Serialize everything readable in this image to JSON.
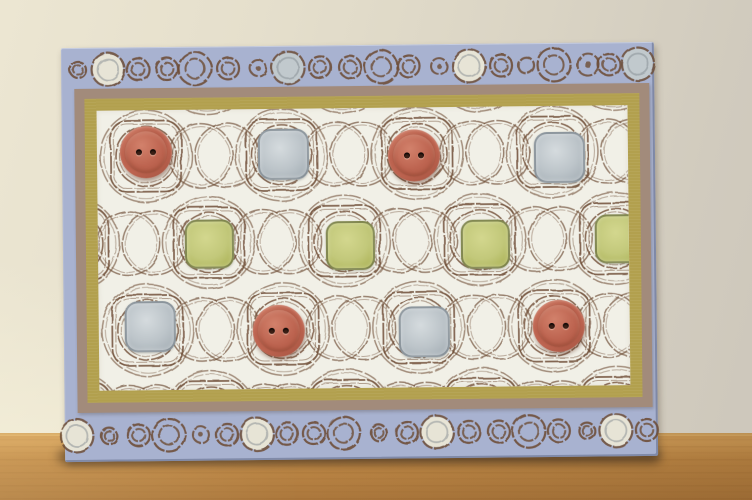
{
  "scene": {
    "type": "photograph",
    "description": "Handmade greeting card leaning against a textured beige plaster wall, standing on a light oak table. Periwinkle-blue card with hand-stamped circle borders top and bottom; central white panel matted in tan and olive-gold, stamped with an interlocking brown pattern of rounded squares and circles. Cells are embellished with terracotta two-hole buttons, celery-green squares and silver-grey squares.",
    "wall": {
      "color_left": "#ece6d2",
      "color_mid": "#dad4c4",
      "color_right": "#cdc7bb"
    },
    "table": {
      "top_y": 433,
      "edge": "#dcae68",
      "light": "#d09c57",
      "main": "#bf8947",
      "dark": "#ab773c"
    },
    "card_contact_shadow": {
      "x": 58,
      "y": 450,
      "width": 602,
      "height": 13
    }
  },
  "card": {
    "x": 63,
    "y": 45,
    "width": 593,
    "height": 414,
    "rotation_deg": -0.6,
    "base_color": "#a8b2d0",
    "ink": "#6f4e36",
    "border_ink": "#6d4c36",
    "cream_fill": "#e7e4d6",
    "silver_fill": "#c1c9cd",
    "inner_ring_gray": "rgba(130,138,144,0.55)",
    "outer_mat": {
      "color": "#a28b7b",
      "x": 13,
      "y": 41,
      "width": 575,
      "height": 324
    },
    "inner_mat": {
      "color": "#b2a04e",
      "inset": 10
    },
    "paper": {
      "color": "#f1f0e7",
      "inset": 12,
      "width": 531,
      "height": 280
    },
    "border_sizes": {
      "L": 16.5,
      "m": 11,
      "s": 8
    },
    "top_border": {
      "cy": 22,
      "circles": [
        {
          "x": 17,
          "size": "s",
          "style": "ring2"
        },
        {
          "x": 47,
          "size": "L",
          "style": "cream"
        },
        {
          "x": 77,
          "size": "m",
          "style": "ring2"
        },
        {
          "x": 106,
          "size": "m",
          "style": "ring2"
        },
        {
          "x": 134,
          "size": "L",
          "style": "ring2"
        },
        {
          "x": 167,
          "size": "m",
          "style": "ring2"
        },
        {
          "x": 197,
          "size": "s",
          "style": "dot"
        },
        {
          "x": 227,
          "size": "L",
          "style": "silver"
        },
        {
          "x": 259,
          "size": "m",
          "style": "ring2"
        },
        {
          "x": 289,
          "size": "m",
          "style": "ring2"
        },
        {
          "x": 320,
          "size": "L",
          "style": "ring2"
        },
        {
          "x": 348,
          "size": "m",
          "style": "ring2"
        },
        {
          "x": 378,
          "size": "s",
          "style": "dot"
        },
        {
          "x": 408,
          "size": "L",
          "style": "cream"
        },
        {
          "x": 440,
          "size": "m",
          "style": "ring2"
        },
        {
          "x": 465,
          "size": "s",
          "style": "ring"
        },
        {
          "x": 493,
          "size": "L",
          "style": "ring2"
        },
        {
          "x": 527,
          "size": "m",
          "style": "dot"
        },
        {
          "x": 548,
          "size": "m",
          "style": "ring2"
        },
        {
          "x": 577,
          "size": "L",
          "style": "silver"
        }
      ]
    },
    "bottom_border": {
      "cy": 22,
      "circles": [
        {
          "x": 12,
          "size": "L",
          "style": "cream"
        },
        {
          "x": 44,
          "size": "s",
          "style": "ring2"
        },
        {
          "x": 74,
          "size": "m",
          "style": "ring2"
        },
        {
          "x": 104,
          "size": "L",
          "style": "ring2"
        },
        {
          "x": 136,
          "size": "s",
          "style": "dot"
        },
        {
          "x": 162,
          "size": "m",
          "style": "ring2"
        },
        {
          "x": 192,
          "size": "L",
          "style": "cream"
        },
        {
          "x": 222,
          "size": "m",
          "style": "ring2"
        },
        {
          "x": 249,
          "size": "m",
          "style": "ring2"
        },
        {
          "x": 279,
          "size": "L",
          "style": "ring2"
        },
        {
          "x": 314,
          "size": "s",
          "style": "ring2"
        },
        {
          "x": 342,
          "size": "m",
          "style": "ring2"
        },
        {
          "x": 372,
          "size": "L",
          "style": "cream"
        },
        {
          "x": 404,
          "size": "m",
          "style": "ring2"
        },
        {
          "x": 434,
          "size": "m",
          "style": "ring2"
        },
        {
          "x": 464,
          "size": "L",
          "style": "ring2"
        },
        {
          "x": 494,
          "size": "m",
          "style": "ring2"
        },
        {
          "x": 522,
          "size": "s",
          "style": "ring2"
        },
        {
          "x": 551,
          "size": "L",
          "style": "cream"
        },
        {
          "x": 582,
          "size": "m",
          "style": "ring2"
        }
      ]
    },
    "pattern": {
      "rows": [
        {
          "y": -41,
          "offset": true
        },
        {
          "y": 46,
          "offset": false
        },
        {
          "y": 133,
          "offset": true
        },
        {
          "y": 220,
          "offset": false
        },
        {
          "y": 307,
          "offset": true
        }
      ],
      "col_start": 49,
      "col_step": 135.5,
      "offset_shift": 62,
      "square_size": 71,
      "square_radius": 17,
      "inner_rings": [
        30,
        26.5
      ],
      "big_circle_r": 46,
      "chain_r": 32,
      "chain_half_gap": 13
    },
    "embellishment_sizes": {
      "button": 52,
      "green": 45,
      "silver": 47
    },
    "embellishments": [
      {
        "type": "button",
        "x": 49,
        "y": 42
      },
      {
        "type": "silver",
        "x": 184,
        "y": 43
      },
      {
        "type": "button",
        "x": 317,
        "y": 48
      },
      {
        "type": "silver",
        "x": 460,
        "y": 49
      },
      {
        "type": "green",
        "x": 109,
        "y": 132
      },
      {
        "type": "green",
        "x": 250,
        "y": 135
      },
      {
        "type": "green",
        "x": 385,
        "y": 135
      },
      {
        "type": "green",
        "x": 519,
        "y": 131
      },
      {
        "type": "silver",
        "x": 49,
        "y": 214
      },
      {
        "type": "button",
        "x": 180,
        "y": 222
      },
      {
        "type": "silver",
        "x": 323,
        "y": 222
      },
      {
        "type": "button",
        "x": 460,
        "y": 220
      }
    ],
    "embellishment_colors": {
      "button": {
        "base": "#bd6450",
        "mid": "#b05a46",
        "dark": "#9a4c3a",
        "light": "#d2816b",
        "hole": "#3b1f15"
      },
      "green": {
        "base": "#c2c87a",
        "light": "#d3d78e",
        "dark": "#a8af50",
        "border": "rgba(88,92,64,0.55)"
      },
      "silver": {
        "base": "#bcc4c9",
        "light": "#d5dbde",
        "dark": "#a1abb2",
        "border": "rgba(106,116,124,0.5)"
      }
    }
  }
}
